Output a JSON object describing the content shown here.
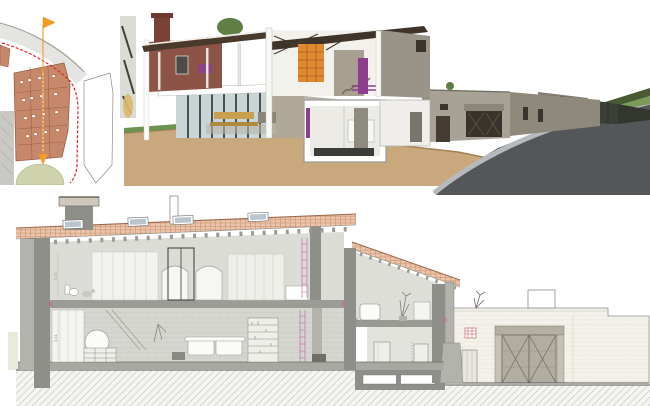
{
  "page": {
    "background": "#ffffff"
  },
  "theme": {
    "paper": "#ffffff",
    "line": "#8c8c87",
    "line_dark": "#55544f",
    "boundary_red": "#e81f1f",
    "marker_orange": "#f59b22",
    "site_roof_brick": "#c5886b",
    "site_roof_line": "#9a5f45",
    "site_road": "#e4e4e0",
    "site_lawn": "#ced3ae",
    "site_gray_block": "#c9c9c3",
    "r3d_brick": "#8e5347",
    "r3d_brick_dark": "#7a4237",
    "r3d_timber": "#4a3a2b",
    "r3d_stone": "#9a9488",
    "r3d_stone_dark": "#827c6f",
    "r3d_fence": "#3c3f36",
    "r3d_orange_shelf": "#e0892f",
    "r3d_purple": "#8d3f8d",
    "r3d_glass": "#c9d6d8",
    "r3d_wood": "#c8a050",
    "r3d_earth": "#c9a87d",
    "r3d_earth_edge": "#a27e51",
    "r3d_grass": "#6f9152",
    "r3d_hedge": "#495932",
    "r3d_road": "#54575a",
    "r3d_sidewalk": "#b7babc",
    "sec_poche": "#8f8f8a",
    "sec_poche_light": "#b3b3ad",
    "sec_interior": "#dcdcd6",
    "sec_interior_low": "#d6d6d0",
    "sec_tile_fill": "#eac5ab",
    "sec_tile_line": "#c2835f",
    "sec_skylight": "#b9c6ce",
    "sec_magenta": "#c757a0",
    "sec_vent_red": "#c0504a",
    "sec_courtyard": "#f3f1ea",
    "sec_exterior_green": "#e7ebdc"
  },
  "panels": {
    "site_plan": {
      "name": "site-location-plan"
    },
    "render_3d": {
      "name": "3d-sectional-cutaway-render"
    },
    "section": {
      "name": "long-section-drawing"
    }
  },
  "section": {
    "dims": {
      "left_upper": "3.17",
      "left_lower": "3.54",
      "wing_upper": "2.26",
      "wing_lower": "2.35"
    }
  }
}
